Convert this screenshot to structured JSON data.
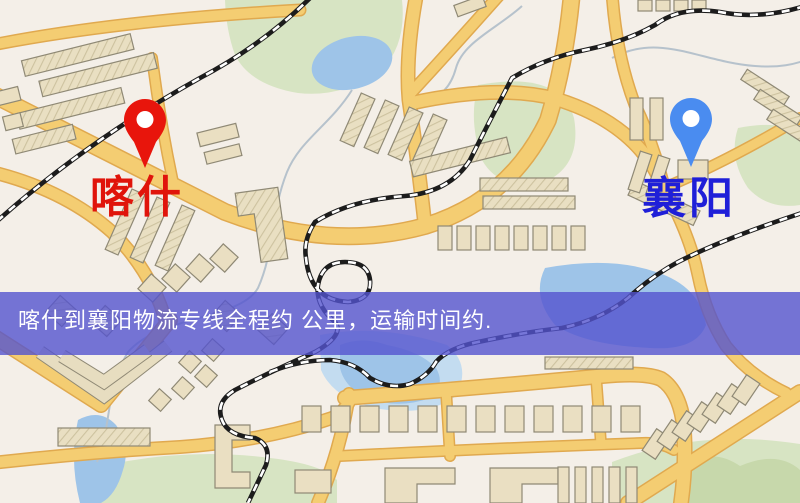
{
  "map": {
    "type": "road-map-static-image",
    "markers": [
      {
        "id": "kashgar",
        "label": "喀什",
        "pin_color": "#e8150c",
        "label_color": "#e0140b"
      },
      {
        "id": "xiangyang",
        "label": "襄阳",
        "pin_color": "#4a8cf0",
        "label_color": "#1f1fd8"
      }
    ],
    "banner": {
      "text": "喀什到襄阳物流专线全程约  公里，运输时间约.",
      "bg_color": "#5454ce",
      "text_color": "#ffffff"
    },
    "palette": {
      "background": "#f4efe8",
      "road": "#f4cd72",
      "road_edge": "#e0a94f",
      "building": "#eadfc2",
      "building_outline": "#8f8975",
      "park": "#d7e4c3",
      "water": "#9ec4e8",
      "railway": "#1c1c1c"
    }
  }
}
